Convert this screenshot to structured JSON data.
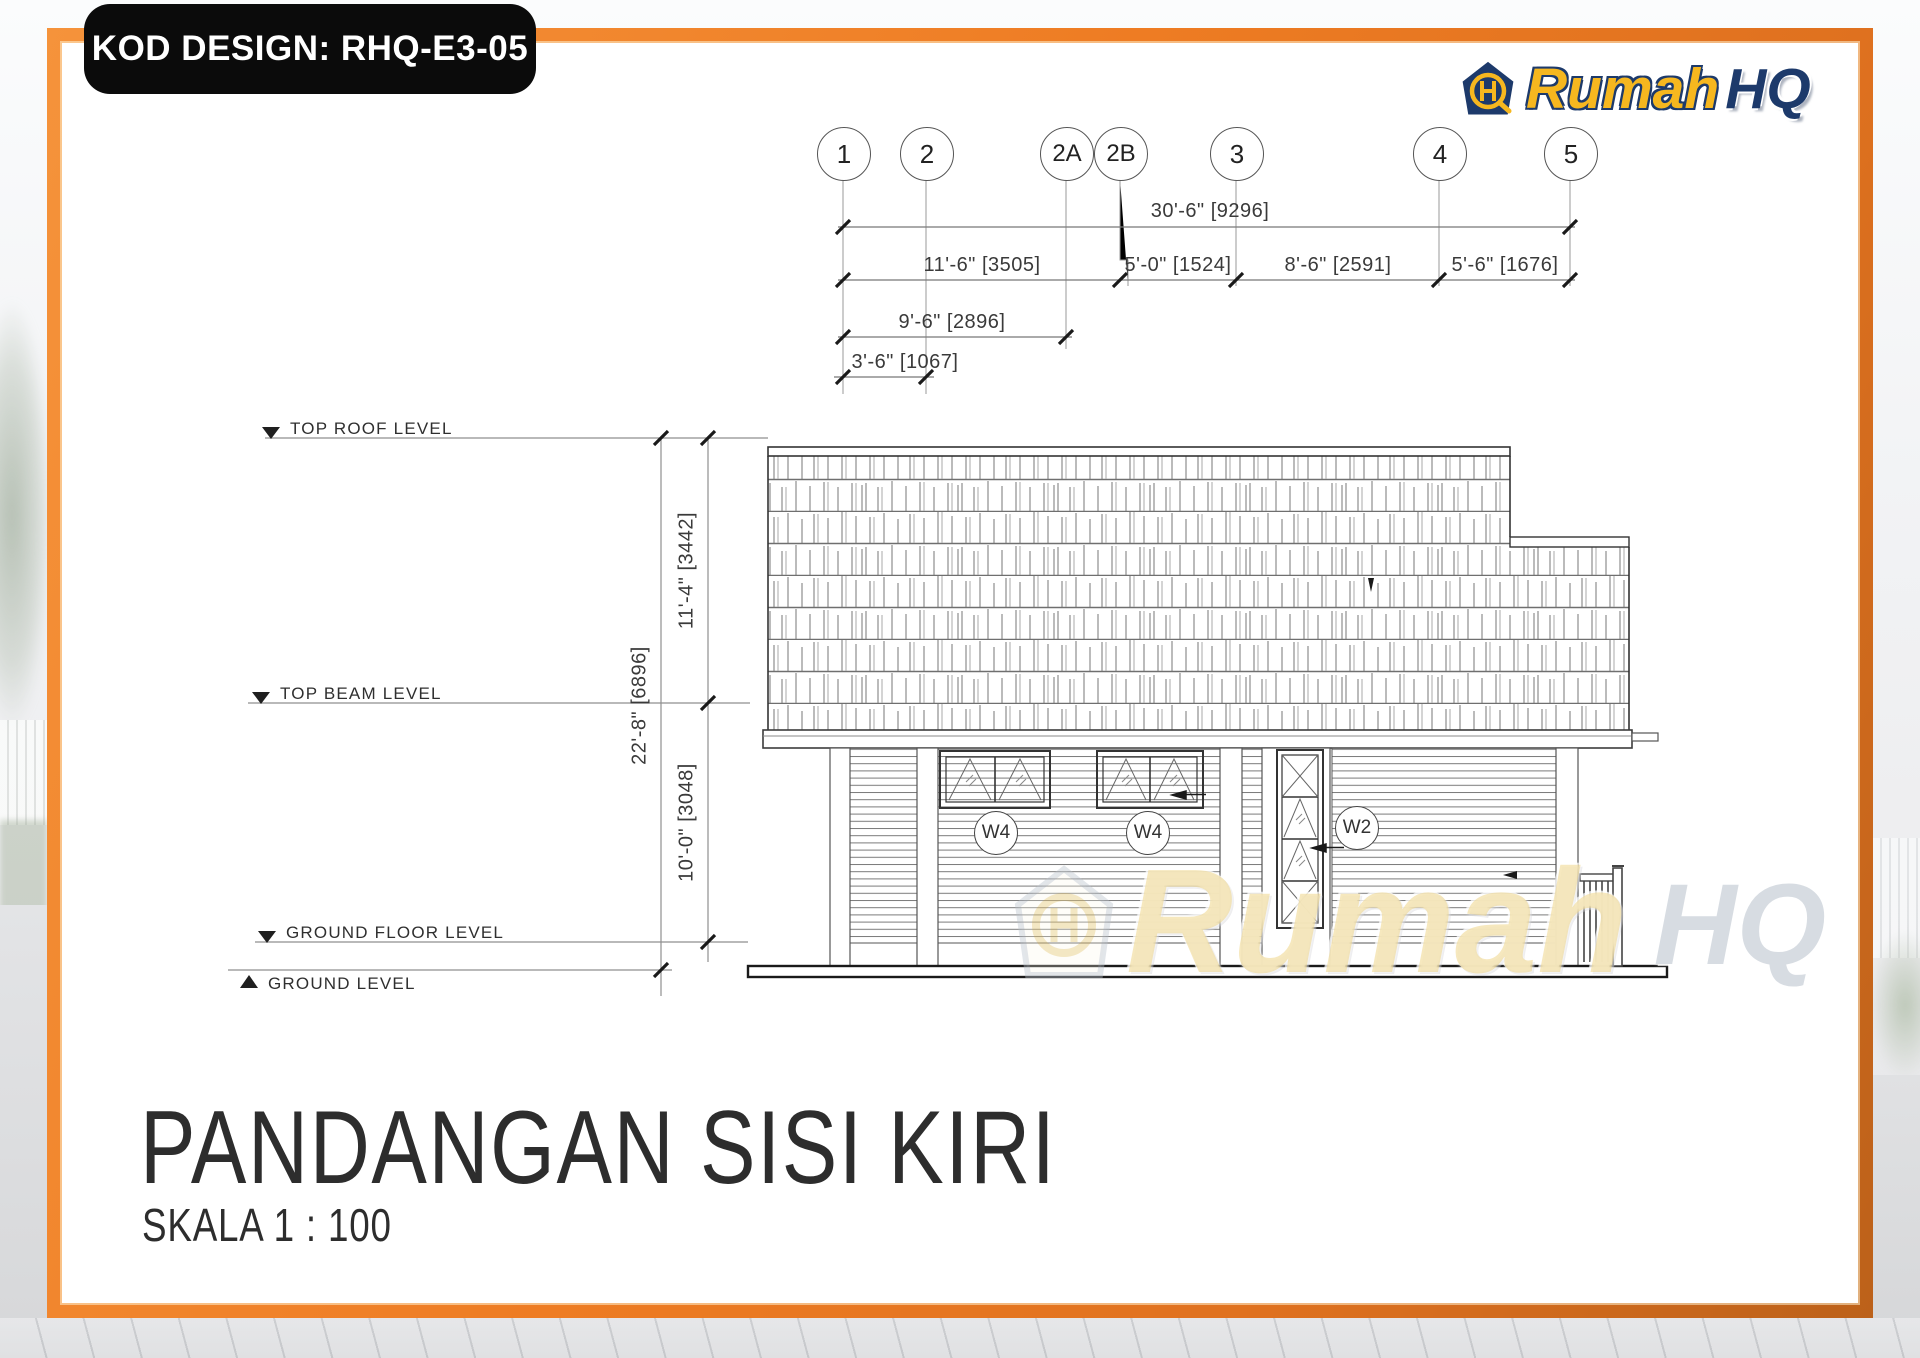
{
  "badge": {
    "label": "KOD DESIGN: RHQ-E3-05"
  },
  "logo": {
    "brand_primary": "Rumah",
    "brand_secondary": "HQ"
  },
  "grid_bubbles": [
    {
      "label": "1"
    },
    {
      "label": "2"
    },
    {
      "label": "2A"
    },
    {
      "label": "2B"
    },
    {
      "label": "3"
    },
    {
      "label": "4"
    },
    {
      "label": "5"
    }
  ],
  "dimensions": {
    "horizontal": {
      "overall": "30'-6\" [9296]",
      "segments": [
        "11'-6\" [3505]",
        "5'-0\" [1524]",
        "8'-6\" [2591]",
        "5'-6\" [1676]"
      ],
      "sub_overall": "9'-6\" [2896]",
      "sub_segment": "3'-6\" [1067]"
    },
    "vertical": {
      "overall": "22'-8\" [6896]",
      "upper": "11'-4\" [3442]",
      "lower": "10'-0\" [3048]"
    }
  },
  "levels": {
    "top_roof": "TOP ROOF LEVEL",
    "top_beam": "TOP BEAM LEVEL",
    "ground_floor": "GROUND FLOOR LEVEL",
    "ground": "GROUND LEVEL"
  },
  "window_tags": [
    {
      "label": "W4"
    },
    {
      "label": "W4"
    },
    {
      "label": "W2"
    }
  ],
  "watermark": {
    "brand_primary": "Rumah",
    "brand_secondary": "HQ"
  },
  "title_block": {
    "title": "PANDANGAN SISI KIRI",
    "scale": "SKALA 1 : 100"
  },
  "colors": {
    "frame_orange": "#EE7C23",
    "badge_black": "#0B0B0B",
    "logo_yellow": "#F6B71F",
    "logo_navy": "#1D3A6B",
    "line_dark": "#333333",
    "line_gray": "#8A8A8A"
  }
}
